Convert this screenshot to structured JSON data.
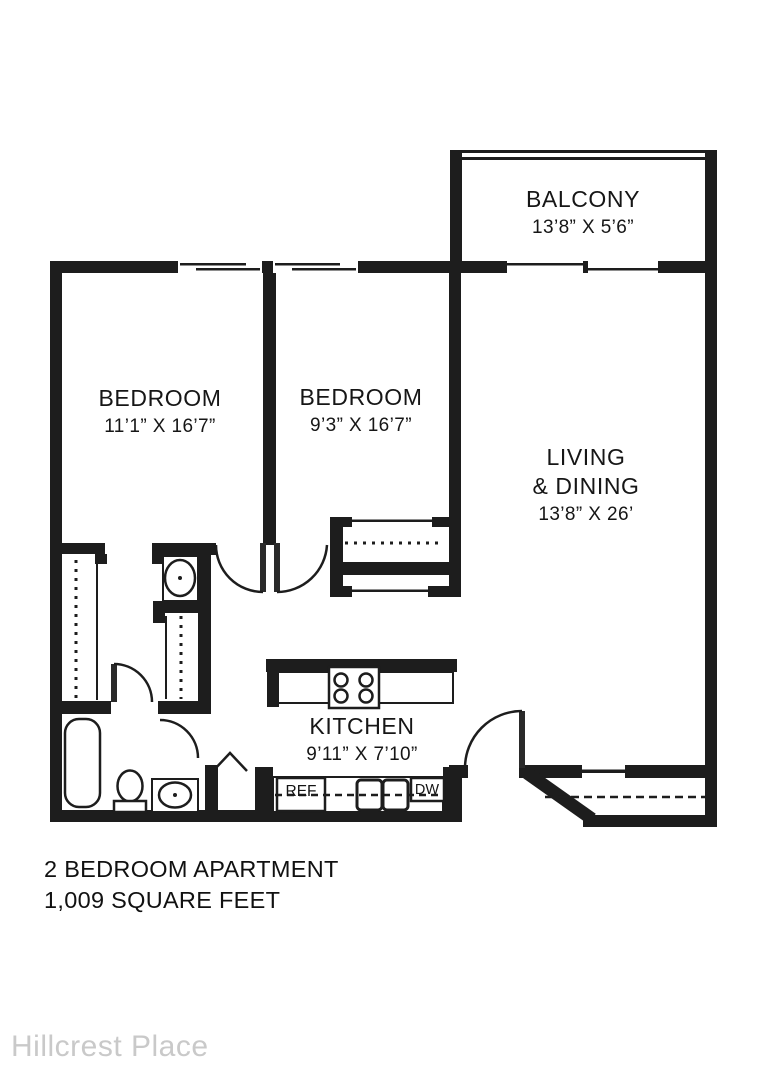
{
  "plan": {
    "rooms": {
      "balcony": {
        "name": "BALCONY",
        "dims": "13’8” X 5’6”"
      },
      "bedroom_left": {
        "name": "BEDROOM",
        "dims": "11’1” X 16’7”"
      },
      "bedroom_middle": {
        "name": "BEDROOM",
        "dims": "9’3” X 16’7”"
      },
      "living_dining": {
        "name_line1": "LIVING",
        "name_line2": "& DINING",
        "dims": "13’8” X 26’"
      },
      "kitchen": {
        "name": "KITCHEN",
        "dims": "9’11” X 7’10”"
      }
    },
    "appliances": {
      "refrigerator": "REF",
      "dishwasher": "DW"
    }
  },
  "footer": {
    "line1": "2 BEDROOM APARTMENT",
    "line2": "1,009 SQUARE FEET"
  },
  "watermark": "Hillcrest Place",
  "colors": {
    "wall": "#1d1d1d",
    "background": "#ffffff",
    "label": "#161616",
    "watermark": "#c9c9c9"
  }
}
